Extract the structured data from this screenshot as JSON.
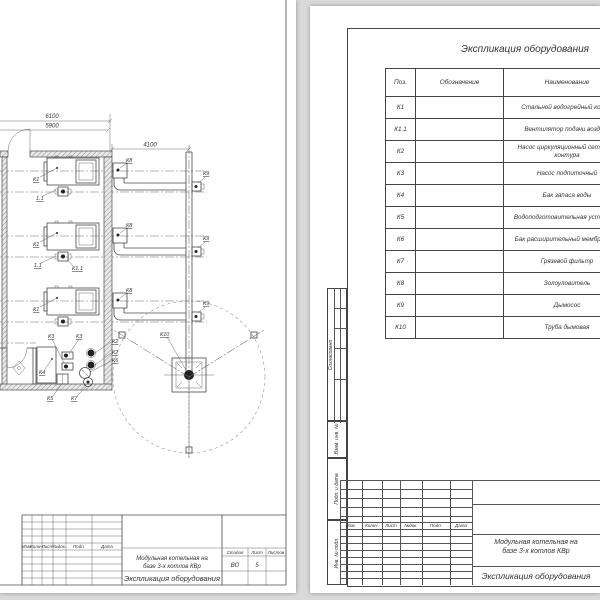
{
  "left_page": {
    "dims": {
      "d6100": "6100",
      "d5900": "5900",
      "d4100": "4100"
    },
    "labels": {
      "boiler": "К1",
      "fan_short": "1.1",
      "fan": "К1.1",
      "ash_catcher": "К8",
      "exhauster": "К9",
      "chimney": "К10",
      "net_pump": "К2",
      "feed_pump": "К3",
      "water_tank": "К4",
      "wtu": "К5",
      "exp_tank": "К6",
      "mud_filter": "К7"
    },
    "title_block": {
      "h_izm": "Изм.",
      "h_kol": "Колич.",
      "h_list": "Лист",
      "h_ndok": "№док.",
      "h_podp": "Подп.",
      "h_data": "Дата",
      "title1": "Модульная котельная на",
      "title2": "базе 3-х котлов КВр",
      "doc_title": "Экспликация оборудования",
      "stage_label": "Стадия",
      "sheet_label": "Лист",
      "sheets_label": "Листов",
      "stage_value": "ВО",
      "sheet_value": "5",
      "format_label": "Формат",
      "format_value": "А3"
    }
  },
  "right_page": {
    "table_title": "Экспликация оборудования",
    "table": {
      "th_pos": "Поз.",
      "th_designation": "Обозначение",
      "th_name": "Наименование",
      "rows": [
        {
          "pos": "К1",
          "name": "Стальной водогрейный котел"
        },
        {
          "pos": "К1.1",
          "name": "Вентилятор подачи воздуха"
        },
        {
          "pos": "К2",
          "name": "Насос циркуляционный сетевого контура"
        },
        {
          "pos": "К3",
          "name": "Насос подпиточный"
        },
        {
          "pos": "К4",
          "name": "Бак запаса воды"
        },
        {
          "pos": "К5",
          "name": "Водоподготовительная установка"
        },
        {
          "pos": "К6",
          "name": "Бак расширительный мембранный"
        },
        {
          "pos": "К7",
          "name": "Грязевой фильтр"
        },
        {
          "pos": "К8",
          "name": "Золоуловитель"
        },
        {
          "pos": "К9",
          "name": "Дымосос"
        },
        {
          "pos": "К10",
          "name": "Труба дымовая"
        }
      ]
    },
    "margin": {
      "agreed": "Согласовано",
      "vzam": "Взам. инв. №",
      "podp_data": "Подп. и дата",
      "inv_podl": "Инв. № подл."
    },
    "title_block": {
      "h_izm": "Изм.",
      "h_kol": "Колич.",
      "h_list": "Лист",
      "h_ndok": "№док.",
      "h_podp": "Подп.",
      "h_data": "Дата",
      "title1": "Модульная котельная на",
      "title2": "базе 3-х котлов КВр",
      "doc_title": "Экспликация оборудования"
    }
  }
}
